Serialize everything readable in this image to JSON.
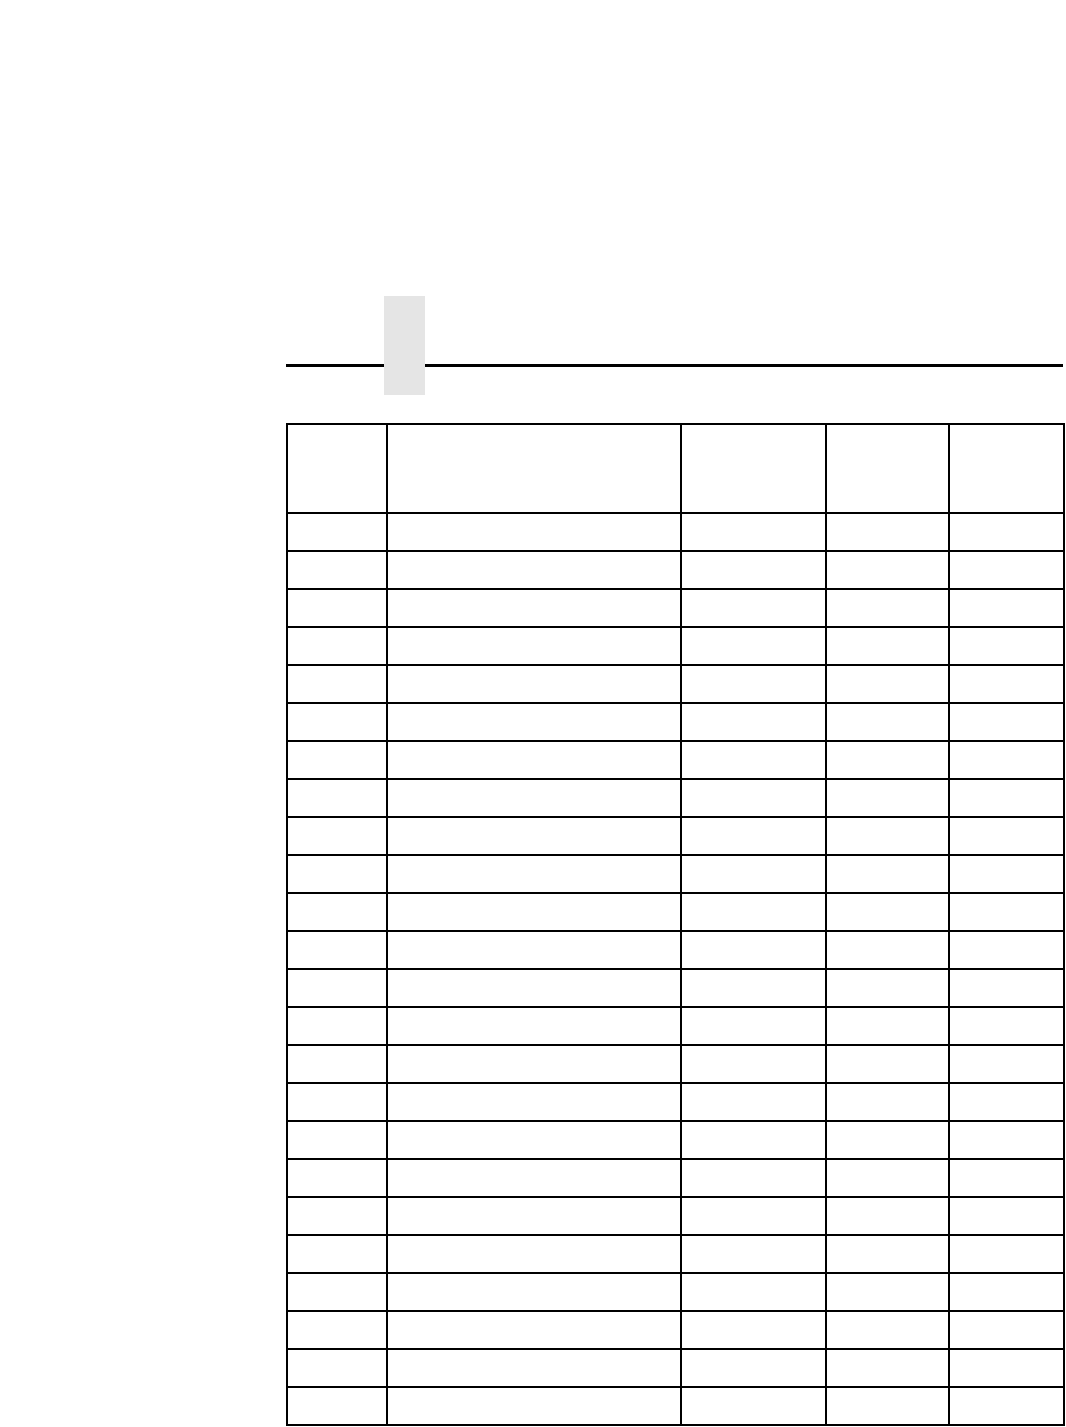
{
  "page": {
    "background_color": "#ffffff",
    "tab_marker_color": "#e5e5e5",
    "rule_color": "#000000"
  },
  "table": {
    "border_color": "#000000",
    "column_count": 5,
    "column_widths_px": [
      100,
      294,
      145,
      123,
      115
    ],
    "header_cells": [
      "",
      "",
      "",
      "",
      ""
    ],
    "row_count": 24,
    "rows": [
      [
        "",
        "",
        "",
        "",
        ""
      ],
      [
        "",
        "",
        "",
        "",
        ""
      ],
      [
        "",
        "",
        "",
        "",
        ""
      ],
      [
        "",
        "",
        "",
        "",
        ""
      ],
      [
        "",
        "",
        "",
        "",
        ""
      ],
      [
        "",
        "",
        "",
        "",
        ""
      ],
      [
        "",
        "",
        "",
        "",
        ""
      ],
      [
        "",
        "",
        "",
        "",
        ""
      ],
      [
        "",
        "",
        "",
        "",
        ""
      ],
      [
        "",
        "",
        "",
        "",
        ""
      ],
      [
        "",
        "",
        "",
        "",
        ""
      ],
      [
        "",
        "",
        "",
        "",
        ""
      ],
      [
        "",
        "",
        "",
        "",
        ""
      ],
      [
        "",
        "",
        "",
        "",
        ""
      ],
      [
        "",
        "",
        "",
        "",
        ""
      ],
      [
        "",
        "",
        "",
        "",
        ""
      ],
      [
        "",
        "",
        "",
        "",
        ""
      ],
      [
        "",
        "",
        "",
        "",
        ""
      ],
      [
        "",
        "",
        "",
        "",
        ""
      ],
      [
        "",
        "",
        "",
        "",
        ""
      ],
      [
        "",
        "",
        "",
        "",
        ""
      ],
      [
        "",
        "",
        "",
        "",
        ""
      ],
      [
        "",
        "",
        "",
        "",
        ""
      ],
      [
        "",
        "",
        "",
        "",
        ""
      ]
    ]
  }
}
